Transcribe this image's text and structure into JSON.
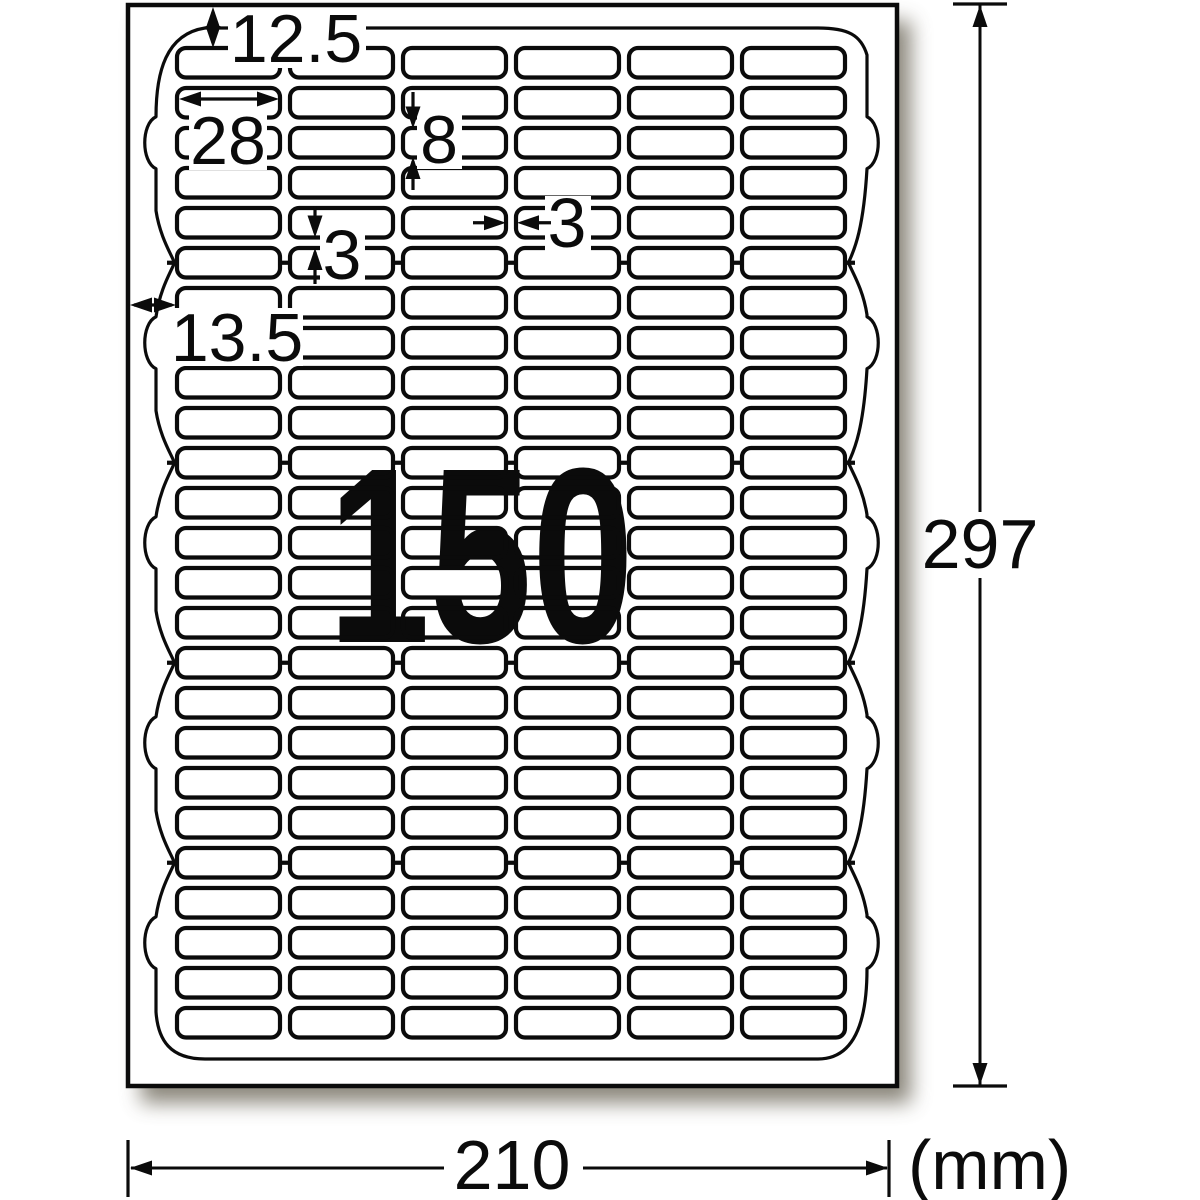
{
  "diagram_type": "label-sheet-dimension-diagram",
  "watermark": {
    "count": "150",
    "color": "#F7A7CC"
  },
  "dims": {
    "top_margin": "12.5",
    "label_width": "28",
    "label_height": "8",
    "row_gap": "3",
    "col_gap": "3",
    "left_margin": "13.5",
    "sheet_height": "297",
    "sheet_width": "210",
    "unit": "(mm)"
  },
  "sheet_spec": {
    "columns": 6,
    "rows": 25,
    "rows_per_block": 5,
    "blocks": 5,
    "labels_total": 150
  },
  "colors": {
    "ink": "#0b0b0b",
    "paper": "#ffffff",
    "shadow": "#6f6a5c"
  }
}
